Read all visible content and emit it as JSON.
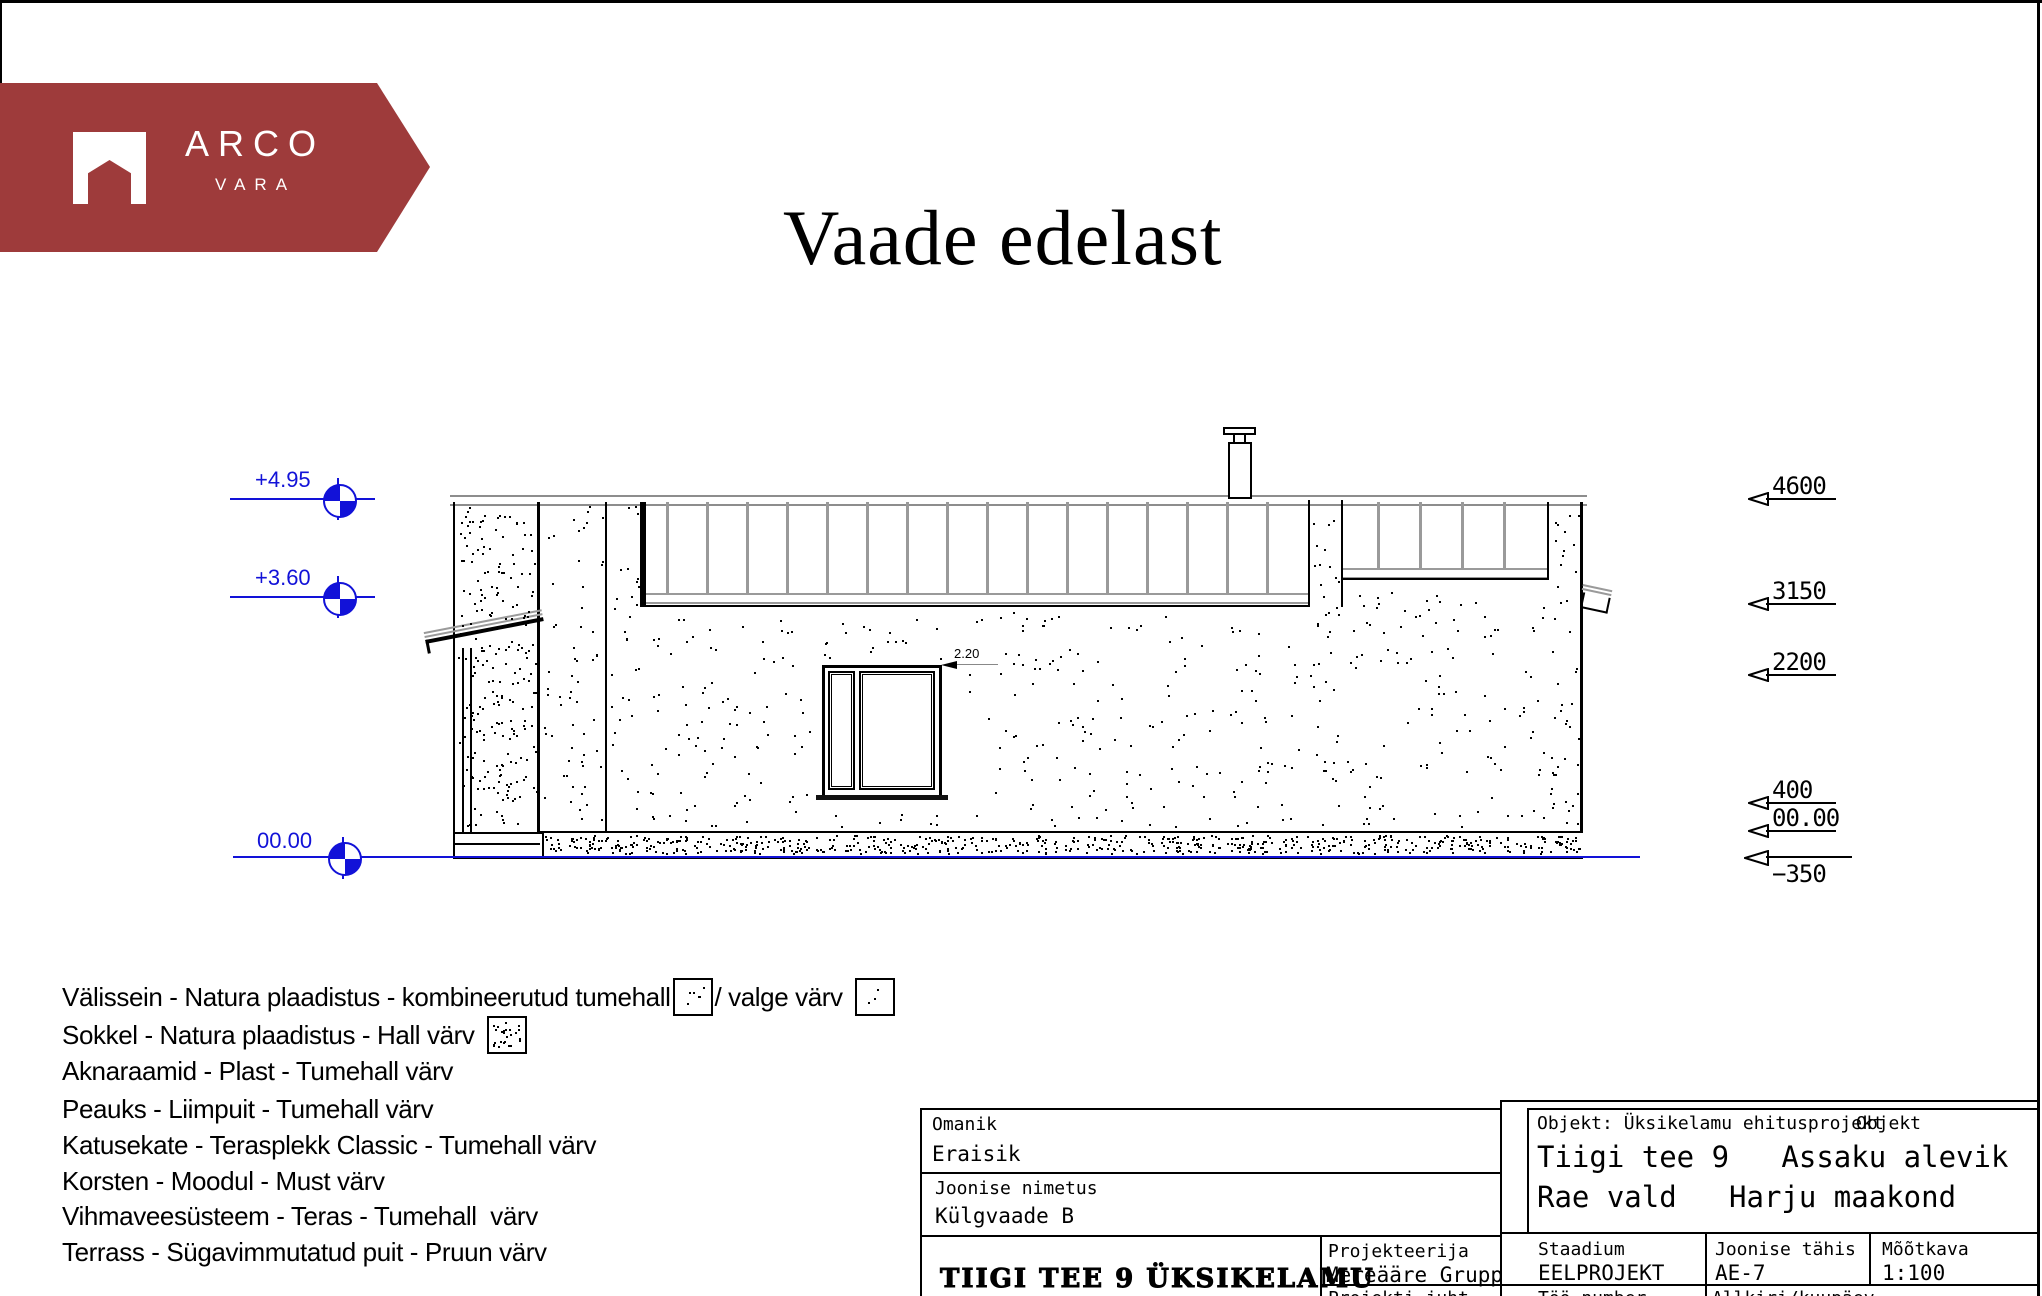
{
  "page": {
    "title": "Vaade edelast"
  },
  "logo": {
    "line1": "ARCO",
    "line2": "VARA",
    "brand_color": "#9e3b3b"
  },
  "colors": {
    "blue": "#1212d8",
    "gray": "#9a9a9a",
    "black": "#000000"
  },
  "left_markers": [
    {
      "label": "+4.95"
    },
    {
      "label": "+3.60"
    },
    {
      "label": "00.00"
    }
  ],
  "right_markers": [
    {
      "label": "4600"
    },
    {
      "label": "3150"
    },
    {
      "label": "2200"
    },
    {
      "label": "400"
    },
    {
      "label": "00.00"
    },
    {
      "label": "−350"
    }
  ],
  "dimension": {
    "label": "2.20"
  },
  "legend": {
    "line1a": "Välissein - Natura plaadistus - kombineerutud tumehall",
    "line1b": "/ valge värv",
    "line2": "Sokkel - Natura plaadistus - Hall värv",
    "line3": "Aknaraamid - Plast - Tumehall värv",
    "line4": "Peauks - Liimpuit - Tumehall värv",
    "line5": "Katusekate - Terasplekk Classic - Tumehall värv",
    "line6": "Korsten - Moodul - Must värv",
    "line7": "Vihmaveesüsteem - Teras - Tumehall  värv",
    "line8": "Terrass - Sügavimmutatud puit - Pruun värv"
  },
  "titleblock": {
    "owner_label": "Omanik",
    "owner": "Eraisik",
    "drawing_label": "Joonise nimetus",
    "drawing": "Külgvaade B",
    "project_title": "TIIGI TEE 9  ÜKSIKELAMU",
    "designer_label": "Projekteerija",
    "designer": "Mereääre Grupp",
    "pm_label": "Projekti juht",
    "object_label": "Objekt: Üksikelamu ehitusprojekt",
    "object_ghost": "Objekt",
    "address1": "Tiigi tee 9   Assaku alevik",
    "address2": "Rae vald   Harju maakond",
    "stage_label": "Staadium",
    "stage": "EELPROJEKT",
    "code_label": "Joonise tähis",
    "code": "AE-7",
    "scale_label": "Mõõtkava",
    "scale": "1:100",
    "worknum_label": "Töö number",
    "sign_label": "Allkiri/kuupäev"
  }
}
